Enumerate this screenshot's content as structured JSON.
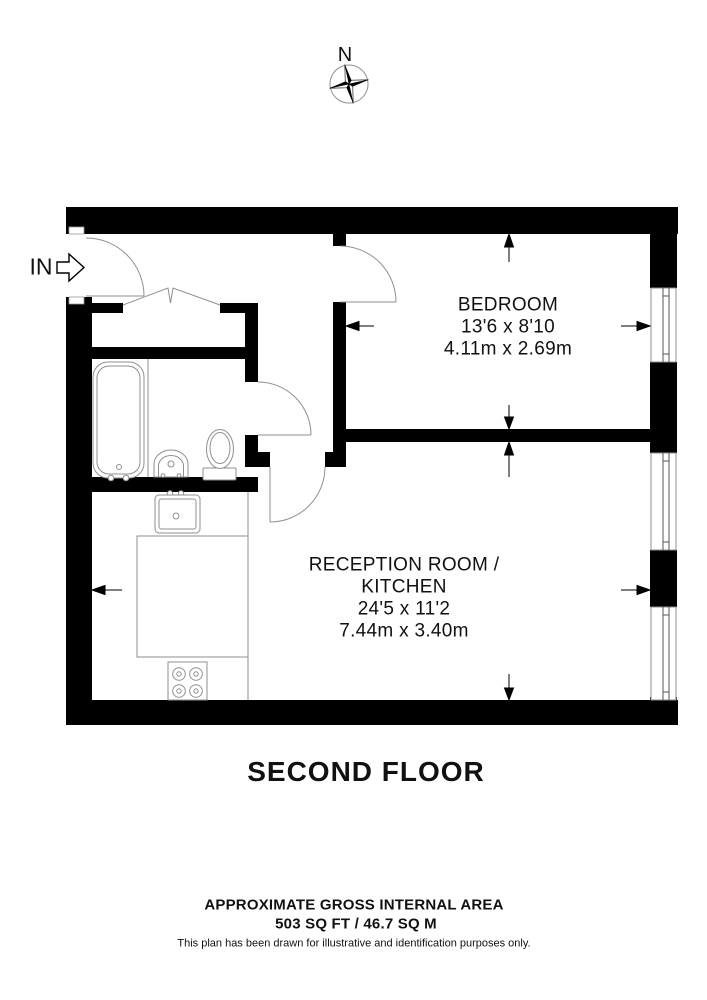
{
  "compass": {
    "north_label": "N"
  },
  "entrance": {
    "label": "IN"
  },
  "rooms": {
    "bedroom": {
      "name": "BEDROOM",
      "dimensions_imperial": "13'6 x 8'10",
      "dimensions_metric": "4.11m x 2.69m"
    },
    "reception": {
      "name_line1": "RECEPTION ROOM /",
      "name_line2": "KITCHEN",
      "dimensions_imperial": "24'5 x 11'2",
      "dimensions_metric": "7.44m x 3.40m"
    }
  },
  "floor": {
    "title": "SECOND FLOOR"
  },
  "footer": {
    "area_heading": "APPROXIMATE GROSS INTERNAL AREA",
    "area_value": "503 SQ FT / 46.7 SQ M",
    "disclaimer": "This plan has been drawn for illustrative and identification purposes only."
  },
  "colors": {
    "wall": "#000000",
    "fixture_line": "#8f8f8f",
    "window_line": "#555555",
    "arrow": "#000000",
    "text": "#111111",
    "background": "#ffffff"
  },
  "icons": {
    "compass": "compass-rose-icon",
    "entry_arrow": "entry-arrow-icon"
  }
}
